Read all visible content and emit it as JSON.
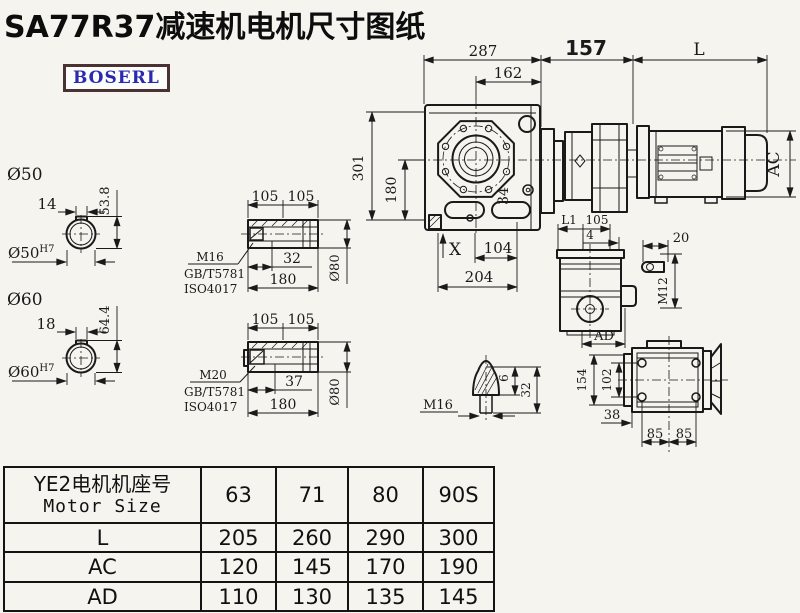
{
  "title": "SA77R37减速机电机尺寸图纸",
  "logo": "BOSERL",
  "dims": {
    "top": {
      "d287": "287",
      "d162": "162",
      "d157": "157",
      "L": "L"
    },
    "front": {
      "d301": "301",
      "d180": "180",
      "d34": "34",
      "X": "X",
      "d104": "104",
      "d204": "204",
      "AC": "AC"
    },
    "shaft50": {
      "label": "Ø50",
      "d14": "14",
      "d53_8": "53.8",
      "bore": "Ø50",
      "boreTol": "H7"
    },
    "shaft60": {
      "label": "Ø60",
      "d18": "18",
      "d64_4": "64.4",
      "bore": "Ø60",
      "boreTol": "H7"
    },
    "hollow1": {
      "d105a": "105",
      "d105b": "105",
      "d32": "32",
      "d180": "180",
      "d80": "Ø80",
      "m": "M16",
      "gb": "GB/T5781",
      "iso": "ISO4017"
    },
    "hollow2": {
      "d105a": "105",
      "d105b": "105",
      "d37": "37",
      "d180": "180",
      "d80": "Ø80",
      "m": "M20",
      "gb": "GB/T5781",
      "iso": "ISO4017"
    },
    "stud": {
      "m": "M16",
      "d6": "6",
      "d32": "32"
    },
    "sideview": {
      "L1": "L1",
      "d105": "105",
      "d4": "4",
      "AD": "AD"
    },
    "key": {
      "d20": "20",
      "m": "M12"
    },
    "topview": {
      "d154": "154",
      "d102": "102",
      "d38": "38",
      "d85a": "85",
      "d85b": "85"
    }
  },
  "table": {
    "header_cn": "YE2电机机座号",
    "header_en": "Motor Size",
    "sizes": [
      "63",
      "71",
      "80",
      "90S"
    ],
    "rows": [
      {
        "label": "L",
        "values": [
          "205",
          "260",
          "290",
          "300"
        ]
      },
      {
        "label": "AC",
        "values": [
          "120",
          "145",
          "170",
          "190"
        ]
      },
      {
        "label": "AD",
        "values": [
          "110",
          "130",
          "135",
          "145"
        ]
      }
    ]
  }
}
